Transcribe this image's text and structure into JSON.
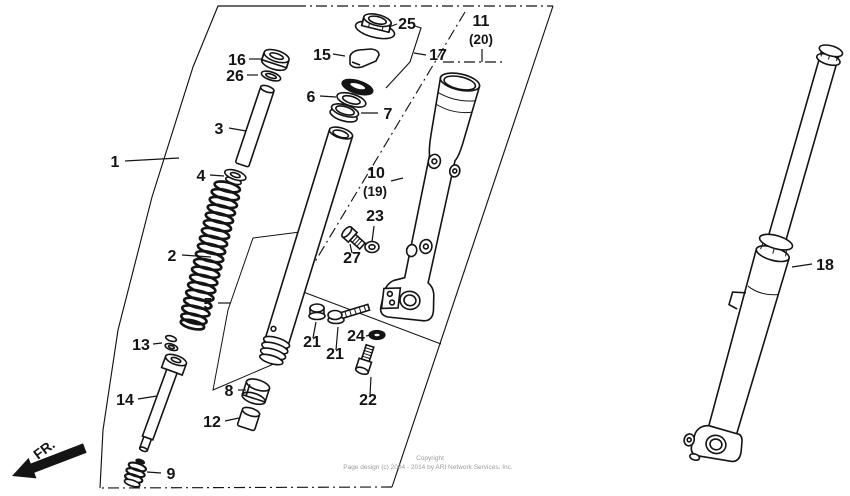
{
  "doc": {
    "title": "Front fork exploded parts diagram",
    "type": "parts-diagram"
  },
  "colors": {
    "line": "#141414",
    "background": "#ffffff",
    "copyright_text": "#9b9b9b"
  },
  "fr_indicator": {
    "label": "FR."
  },
  "copyright": {
    "line1": "Copyright",
    "line2": "Page design (c) 2004 - 2014 by ARI Network Services, Inc."
  },
  "callouts": [
    {
      "part": "1",
      "text": "1",
      "x": 115,
      "y": 167,
      "leader": [
        [
          125,
          161
        ],
        [
          179,
          158
        ]
      ]
    },
    {
      "part": "2",
      "text": "2",
      "x": 172,
      "y": 261,
      "leader": [
        [
          182,
          255
        ],
        [
          211,
          257
        ]
      ]
    },
    {
      "part": "3",
      "text": "3",
      "x": 219,
      "y": 134,
      "leader": [
        [
          229,
          128
        ],
        [
          246,
          131
        ]
      ]
    },
    {
      "part": "4",
      "text": "4",
      "x": 201,
      "y": 181,
      "leader": [
        [
          210,
          175
        ],
        [
          224,
          176
        ]
      ]
    },
    {
      "part": "5",
      "text": "5",
      "x": 208,
      "y": 309,
      "leader": [
        [
          218,
          303
        ],
        [
          231,
          303
        ]
      ]
    },
    {
      "part": "6",
      "text": "6",
      "x": 311,
      "y": 102,
      "leader": [
        [
          320,
          96
        ],
        [
          336,
          97
        ]
      ]
    },
    {
      "part": "7",
      "text": "7",
      "x": 388,
      "y": 119,
      "leader": [
        [
          378,
          113
        ],
        [
          361,
          113
        ]
      ]
    },
    {
      "part": "8",
      "text": "8",
      "x": 229,
      "y": 396,
      "leader": [
        [
          238,
          390
        ],
        [
          246,
          390
        ]
      ]
    },
    {
      "part": "9",
      "text": "9",
      "x": 171,
      "y": 479,
      "leader": [
        [
          161,
          473
        ],
        [
          147,
          472
        ]
      ]
    },
    {
      "part": "10",
      "text": "10",
      "x": 376,
      "y": 178,
      "leader": [
        [
          391,
          181
        ],
        [
          403,
          178
        ]
      ]
    },
    {
      "part": "10b",
      "text": "(19)",
      "x": 375,
      "y": 196,
      "small": true
    },
    {
      "part": "11",
      "text": "11",
      "x": 481,
      "y": 26
    },
    {
      "part": "11b",
      "text": "(20)",
      "x": 481,
      "y": 44,
      "small": true,
      "leader": [
        [
          482,
          49
        ],
        [
          482,
          62
        ]
      ]
    },
    {
      "part": "12",
      "text": "12",
      "x": 212,
      "y": 427,
      "leader": [
        [
          225,
          421
        ],
        [
          239,
          418
        ]
      ]
    },
    {
      "part": "13",
      "text": "13",
      "x": 141,
      "y": 350,
      "leader": [
        [
          153,
          344
        ],
        [
          162,
          343
        ]
      ]
    },
    {
      "part": "14",
      "text": "14",
      "x": 125,
      "y": 405,
      "leader": [
        [
          138,
          399
        ],
        [
          157,
          396
        ]
      ]
    },
    {
      "part": "15",
      "text": "15",
      "x": 322,
      "y": 60,
      "leader": [
        [
          333,
          54
        ],
        [
          345,
          56
        ]
      ]
    },
    {
      "part": "16",
      "text": "16",
      "x": 237,
      "y": 65,
      "leader": [
        [
          249,
          59
        ],
        [
          261,
          59
        ]
      ]
    },
    {
      "part": "17",
      "text": "17",
      "x": 438,
      "y": 60,
      "leader": [
        [
          426,
          55
        ],
        [
          414,
          53
        ]
      ]
    },
    {
      "part": "18",
      "text": "18",
      "x": 825,
      "y": 270,
      "leader": [
        [
          812,
          264
        ],
        [
          792,
          267
        ]
      ]
    },
    {
      "part": "21a",
      "text": "21",
      "x": 312,
      "y": 347,
      "leader": [
        [
          313,
          338
        ],
        [
          316,
          322
        ]
      ]
    },
    {
      "part": "21b",
      "text": "21",
      "x": 335,
      "y": 359,
      "leader": [
        [
          336,
          350
        ],
        [
          338,
          327
        ]
      ]
    },
    {
      "part": "22",
      "text": "22",
      "x": 368,
      "y": 405,
      "leader": [
        [
          370,
          395
        ],
        [
          371,
          377
        ]
      ]
    },
    {
      "part": "23",
      "text": "23",
      "x": 375,
      "y": 221,
      "leader": [
        [
          374,
          226
        ],
        [
          372,
          242
        ]
      ]
    },
    {
      "part": "24",
      "text": "24",
      "x": 356,
      "y": 341,
      "leader": [
        [
          366,
          336
        ],
        [
          371,
          335
        ]
      ]
    },
    {
      "part": "25",
      "text": "25",
      "x": 407,
      "y": 29,
      "leader": [
        [
          397,
          24
        ],
        [
          389,
          27
        ]
      ]
    },
    {
      "part": "26",
      "text": "26",
      "x": 235,
      "y": 81,
      "leader": [
        [
          247,
          75
        ],
        [
          258,
          75
        ]
      ]
    },
    {
      "part": "27",
      "text": "27",
      "x": 352,
      "y": 263,
      "leader": [
        [
          352,
          253
        ],
        [
          350,
          244
        ]
      ]
    }
  ]
}
